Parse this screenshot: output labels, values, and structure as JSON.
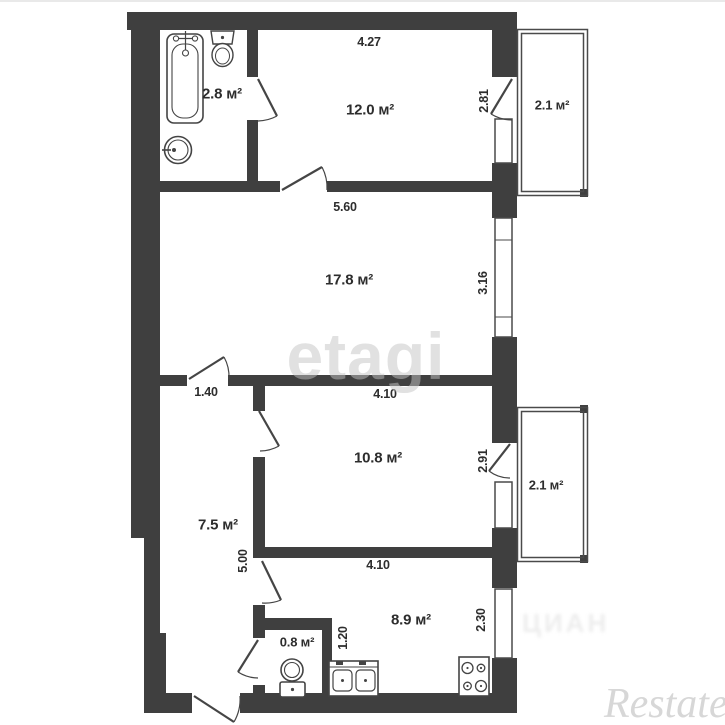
{
  "plan": {
    "rooms": [
      {
        "name": "bathroom",
        "area": "2.8 м²"
      },
      {
        "name": "room-12",
        "area": "12.0 м²"
      },
      {
        "name": "balcony-top",
        "area": "2.1 м²"
      },
      {
        "name": "living-room",
        "area": "17.8 м²"
      },
      {
        "name": "room-10",
        "area": "10.8 м²"
      },
      {
        "name": "balcony-bottom",
        "area": "2.1 м²"
      },
      {
        "name": "hallway",
        "area": "7.5 м²"
      },
      {
        "name": "kitchen",
        "area": "8.9 м²"
      },
      {
        "name": "wc",
        "area": "0.8 м²"
      }
    ],
    "dimensions": [
      {
        "label": "4.27",
        "orientation": "horizontal"
      },
      {
        "label": "2.81",
        "orientation": "vertical"
      },
      {
        "label": "5.60",
        "orientation": "horizontal"
      },
      {
        "label": "3.16",
        "orientation": "vertical"
      },
      {
        "label": "1.40",
        "orientation": "horizontal"
      },
      {
        "label": "4.10",
        "orientation": "horizontal"
      },
      {
        "label": "2.91",
        "orientation": "vertical"
      },
      {
        "label": "5.00",
        "orientation": "vertical"
      },
      {
        "label": "4.10",
        "orientation": "horizontal"
      },
      {
        "label": "2.30",
        "orientation": "vertical"
      },
      {
        "label": "1.20",
        "orientation": "vertical"
      }
    ],
    "fixtures": [
      "bathtub",
      "toilet",
      "round-washbasin",
      "toilet",
      "double-kitchen-sink",
      "stove-4-burners"
    ],
    "watermarks": {
      "center": "etagi",
      "bottom_right": "Restate",
      "faint": "ЦИАН"
    },
    "colors": {
      "wall": "#3f3f3f",
      "thin_line": "#4a4a4a",
      "text": "#2d2d2d",
      "watermark": "#e9e9e9",
      "background": "#ffffff"
    }
  }
}
